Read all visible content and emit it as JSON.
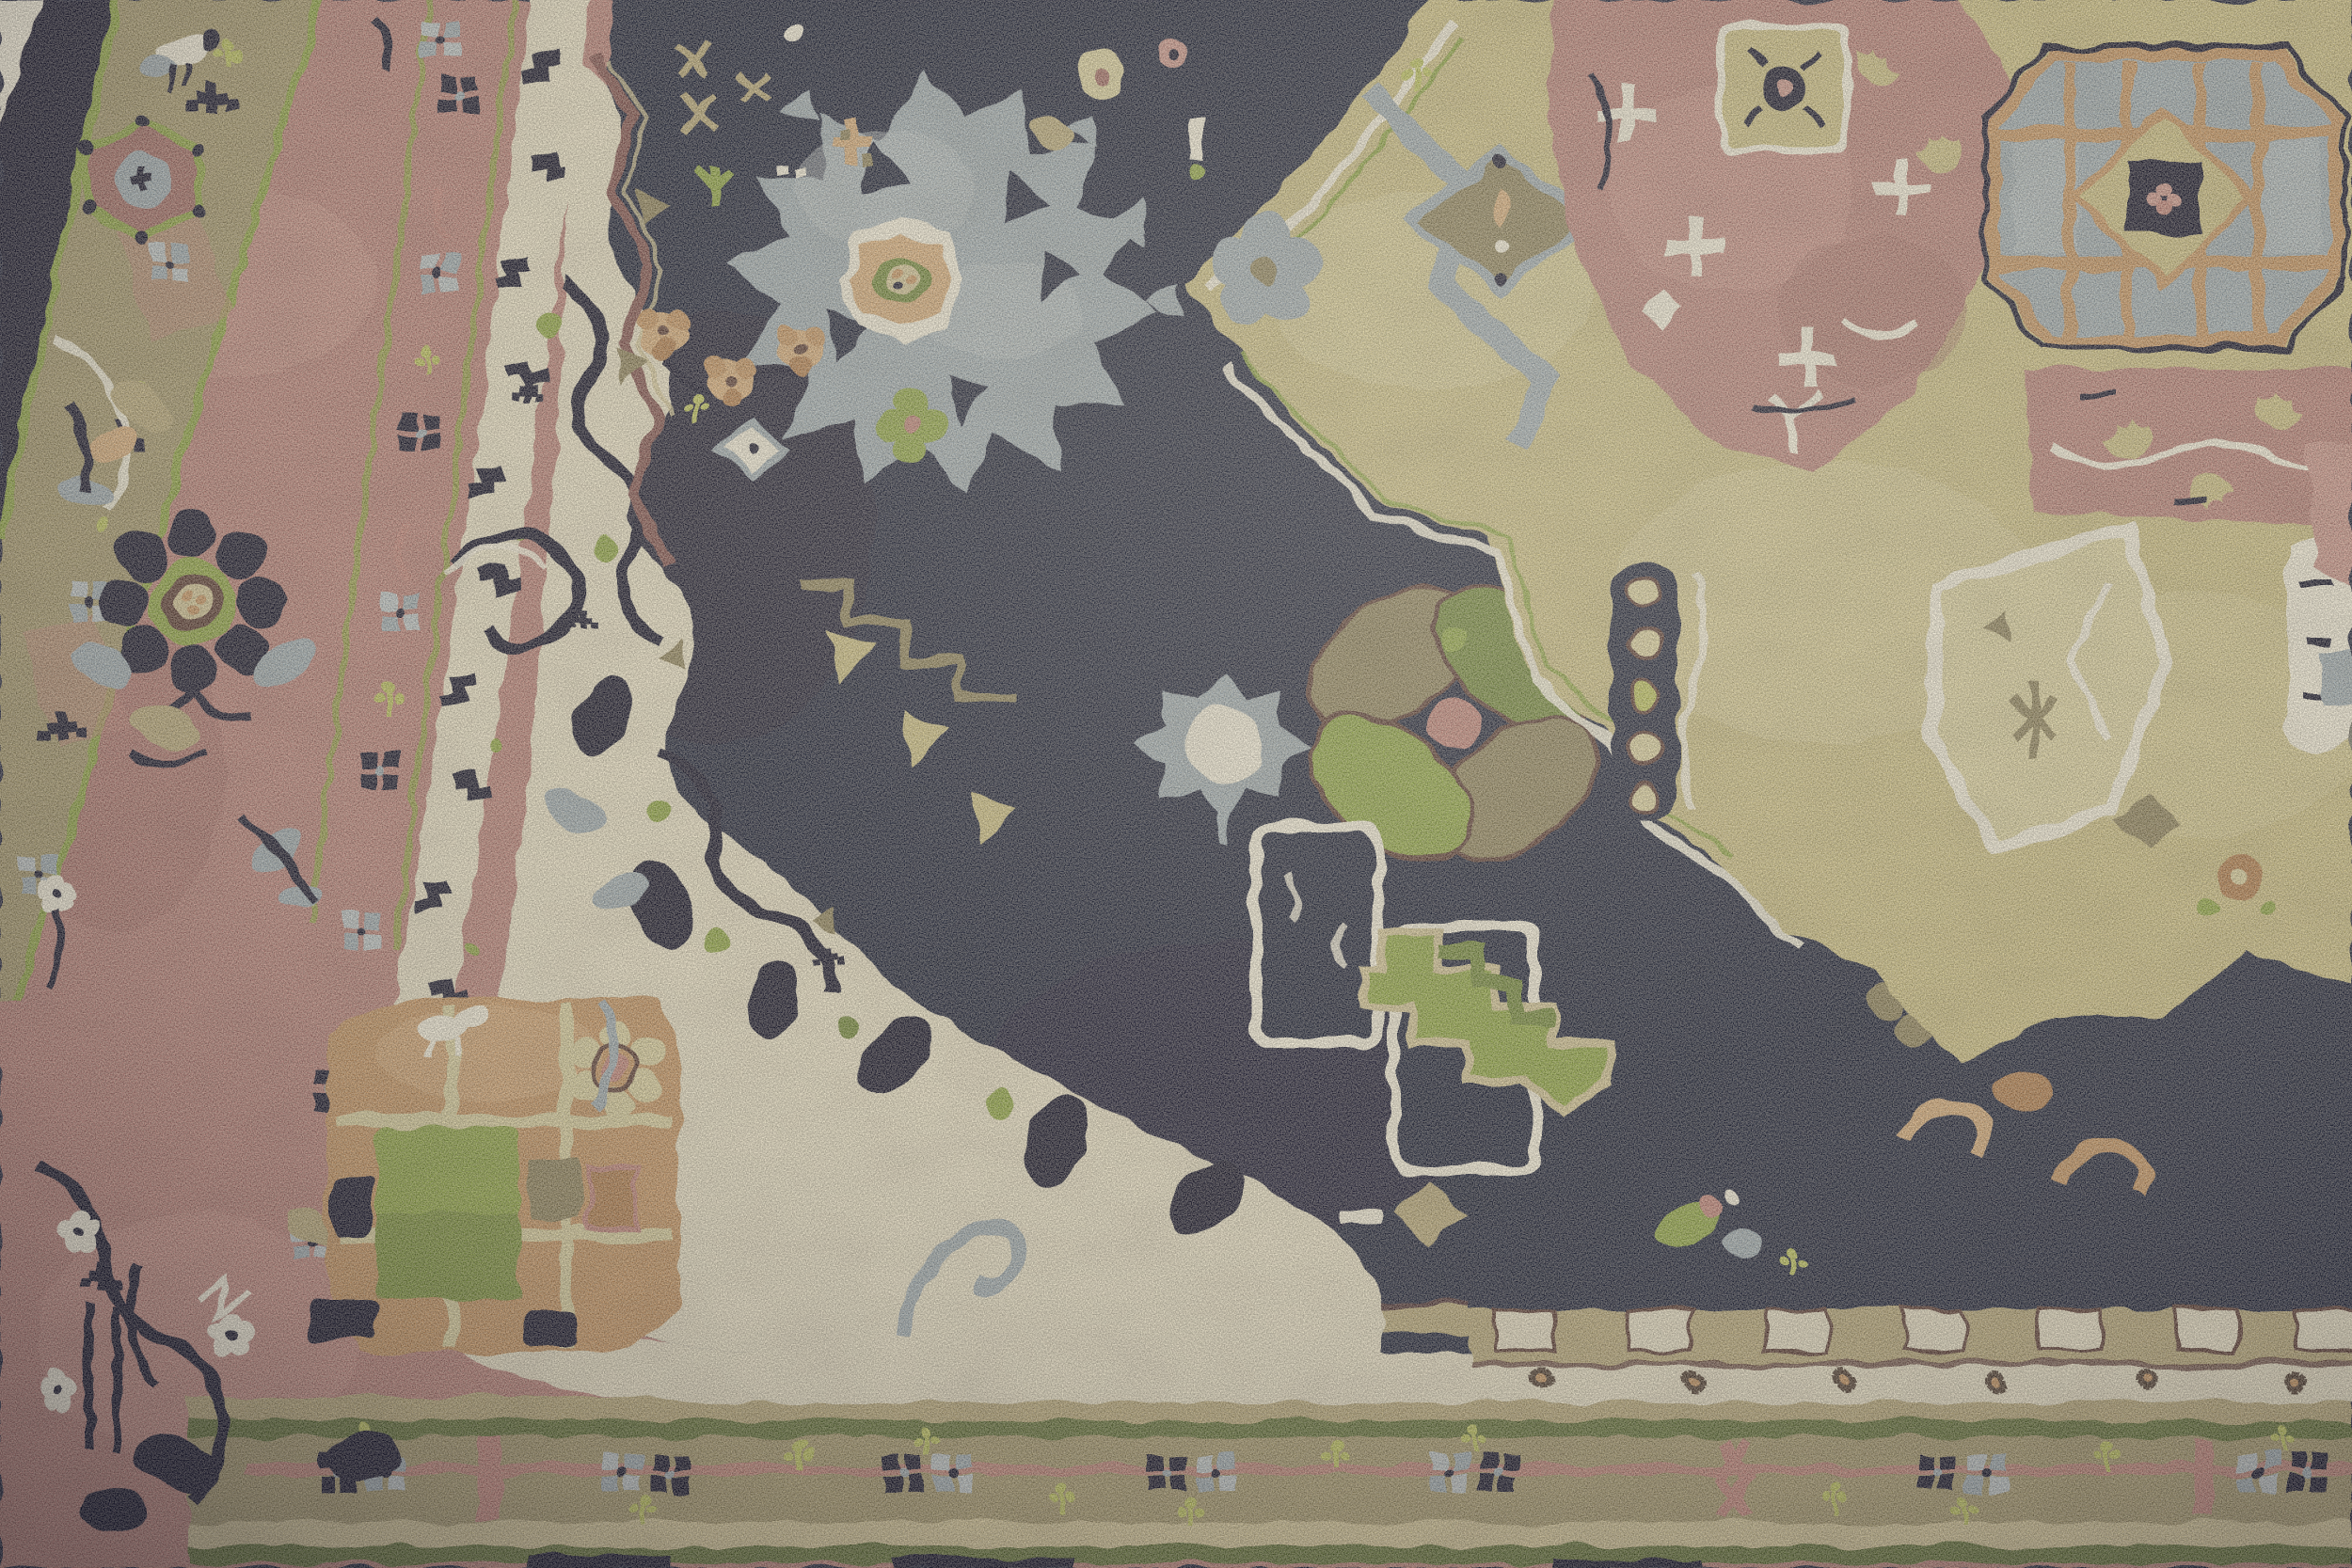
{
  "image": {
    "type": "photograph",
    "subject": "Hand-knotted Heriz / Serapi style oriental wool rug, angled close-up",
    "orientation": "rug photographed at a slight diagonal; borders run along the left edge and bottom edge",
    "texture": "cut wool pile with visible knots"
  },
  "palette": {
    "navy": "#181c36",
    "navyDeep": "#0e1128",
    "navyLight": "#2a3154",
    "cream": "#eae2c8",
    "white": "#f6f1df",
    "pink": "#b87e77",
    "pinkLight": "#cb948b",
    "pinkDark": "#a06762",
    "rose": "#c08178",
    "mauve": "#7e4e4b",
    "olive": "#a3966a",
    "oliveDark": "#80754e",
    "tan": "#b8a878",
    "tanLight": "#d2c495",
    "khaki": "#ccbf82",
    "khakiLight": "#ddd3a0",
    "drab": "#8b7f58",
    "grey": "#9dabb3",
    "greyLight": "#bcc5c9",
    "green": "#6d8435",
    "greenBright": "#8ca43f",
    "yellowGreen": "#bcc35a",
    "greenStripe": "#5b6c31",
    "orange": "#c6935f",
    "orangeLight": "#d8ac79",
    "copper": "#b07a4a",
    "brown": "#46352a",
    "maroon": "#55352f"
  },
  "regions": {
    "background": {
      "label": "pale surface visible at extreme top-left corner",
      "color_ref": "white"
    },
    "outer_edge": {
      "label": "dark navy outer edge band, left side",
      "color_ref": "navyDeep"
    },
    "outer_minor_border": {
      "label": "olive minor border with rosettes and crosses, left side",
      "color_ref": "olive"
    },
    "main_border": {
      "label": "rose-pink main border with rosettes, vines and white blossoms",
      "color_ref": "pink"
    },
    "inner_minor_border": {
      "label": "olive rosette minor border between pink border and field",
      "color_ref": "olive"
    },
    "meander_border": {
      "label": "ivory guard border with navy meander hooks",
      "color_ref": "cream"
    },
    "field": {
      "label": "midnight-navy field with floral ornaments",
      "color_ref": "navy"
    },
    "ivory_spandrel": {
      "label": "ivory spandrel with navy vine scrolls",
      "color_ref": "cream"
    },
    "corner_block": {
      "label": "apricot corner blossom panel with green patch",
      "color_ref": "orange"
    },
    "grey_medallion": {
      "label": "grey-blue serrated leaf medallion with orange hexagon centre",
      "color_ref": "grey"
    },
    "khaki_medallion": {
      "label": "large khaki stepped medallion, upper right",
      "color_ref": "khaki"
    },
    "pink_medallion": {
      "label": "rose inner medallion with white arrow ornaments",
      "color_ref": "pink"
    },
    "lattice_octagon": {
      "label": "grey lattice octagon with khaki diamond and navy centre square",
      "color_ref": "grey"
    },
    "leaf_rosette": {
      "label": "green and drab pinwheel leaf rosette with rose centre",
      "color_ref": "green"
    },
    "bottom_border": {
      "label": "horizontal bands: tan, green stripes, olive rosette band with rose line, pink edge",
      "color_ref": "olive"
    },
    "crenellation": {
      "label": "ivory crenellated strip with brown star dots, lower right",
      "color_ref": "cream"
    }
  }
}
